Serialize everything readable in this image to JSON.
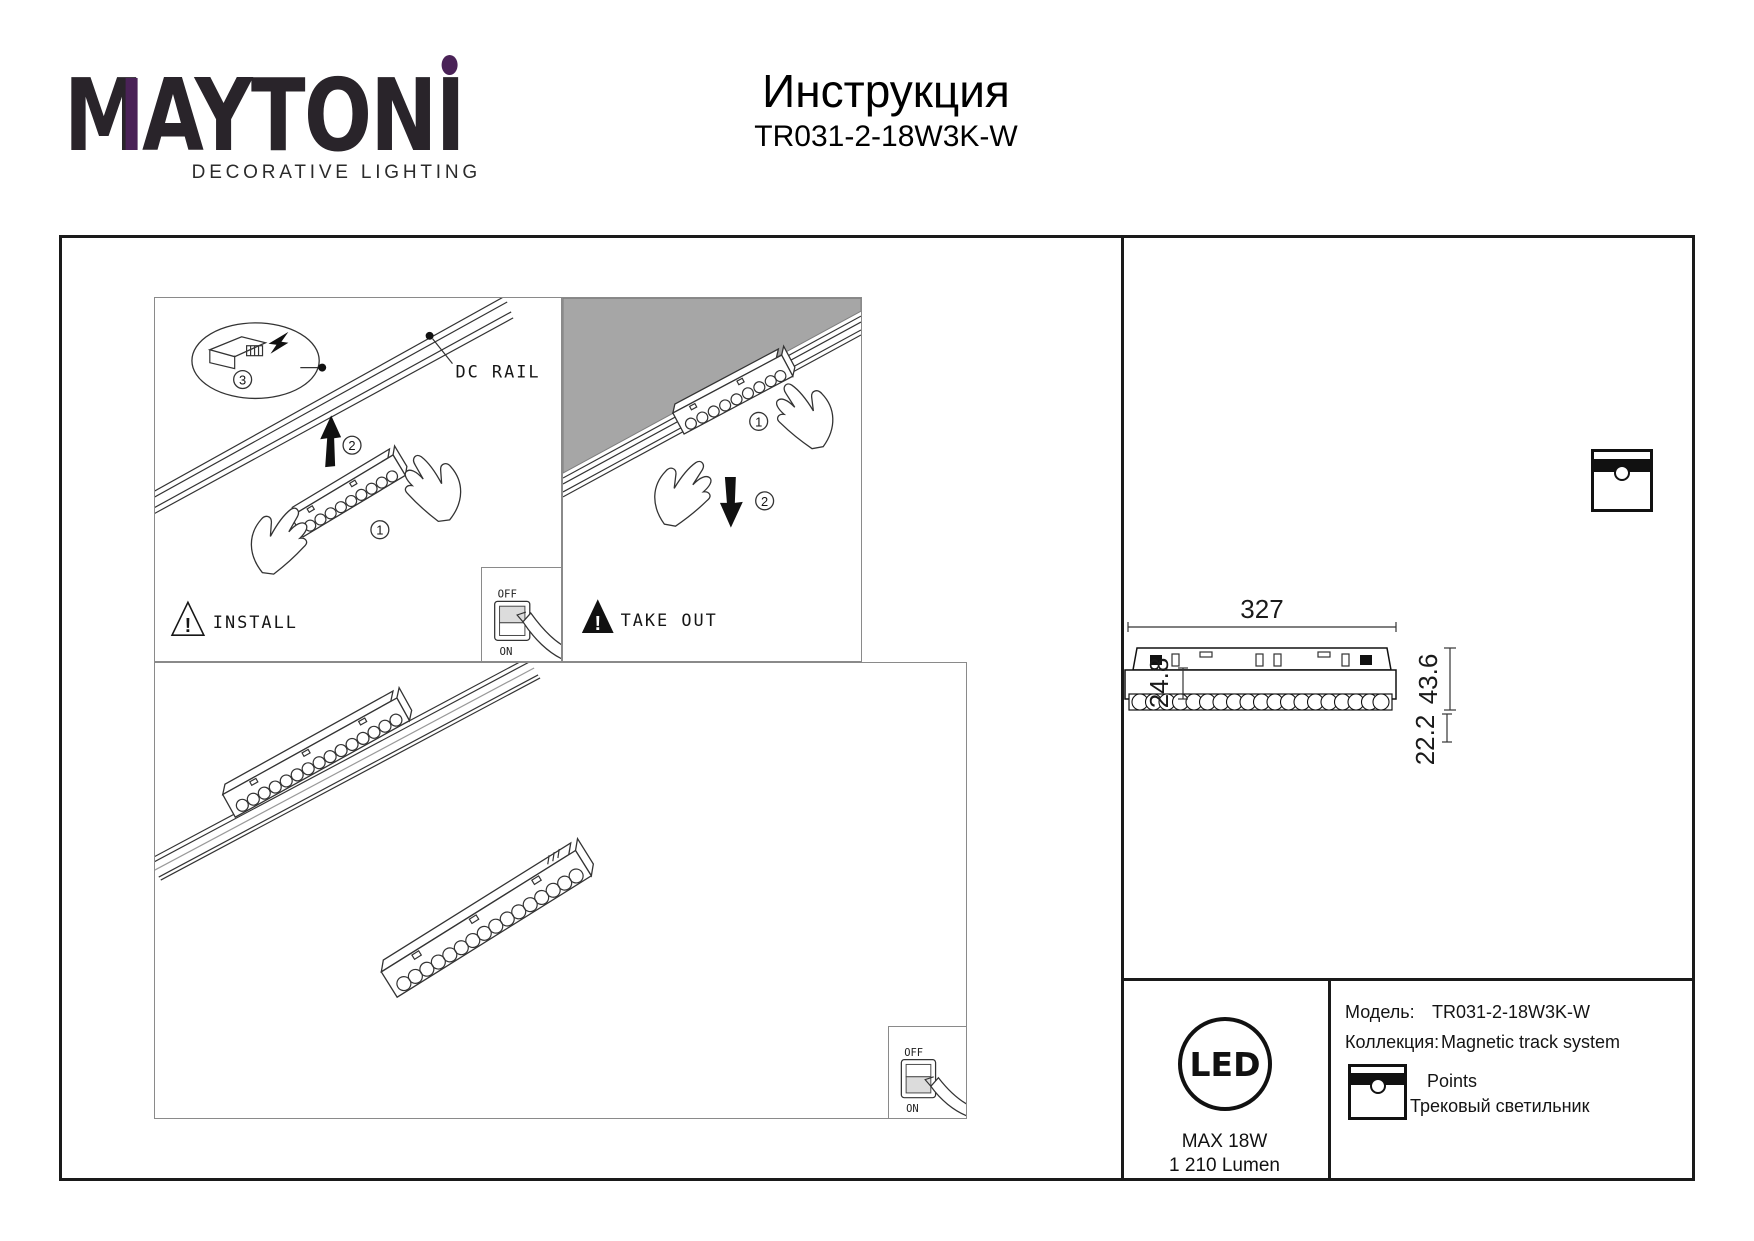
{
  "colors": {
    "accent_purple": "#4A2257",
    "ink": "#1A1A1A",
    "panel_border_gray": "#8A8A8A",
    "ceiling_gray": "#A6A6A6"
  },
  "logo": {
    "brand": "MAYTONI",
    "brand_m": "M",
    "brand_mid": "AYTON",
    "brand_i": "I",
    "tagline": "DECORATIVE LIGHTING"
  },
  "header": {
    "title": "Инструкция",
    "model": "TR031-2-18W3K-W"
  },
  "panels": {
    "install": {
      "label": "INSTALL",
      "warning_mark": "!",
      "rail_label": "DC RAIL",
      "step_1": "1",
      "step_2": "2",
      "step_3": "3"
    },
    "take_out": {
      "label": "TAKE OUT",
      "warning_mark": "!",
      "step_1": "1",
      "step_2": "2"
    },
    "power_switch": {
      "off": "OFF",
      "on": "ON"
    }
  },
  "dimensions_mm": {
    "length": "327",
    "body_height": "24.8",
    "total_height": "43.6",
    "depth": "22.2"
  },
  "spec": {
    "led_mark": "LED",
    "max_power": "MAX 18W",
    "luminous_flux": "1 210 Lumen"
  },
  "product_info": {
    "model_label": "Модель:",
    "model_value": "TR031-2-18W3K-W",
    "collection_label": "Коллекция:",
    "collection_value": "Magnetic track system",
    "collection_series": "Points",
    "product_type": "Трековый светильник"
  }
}
